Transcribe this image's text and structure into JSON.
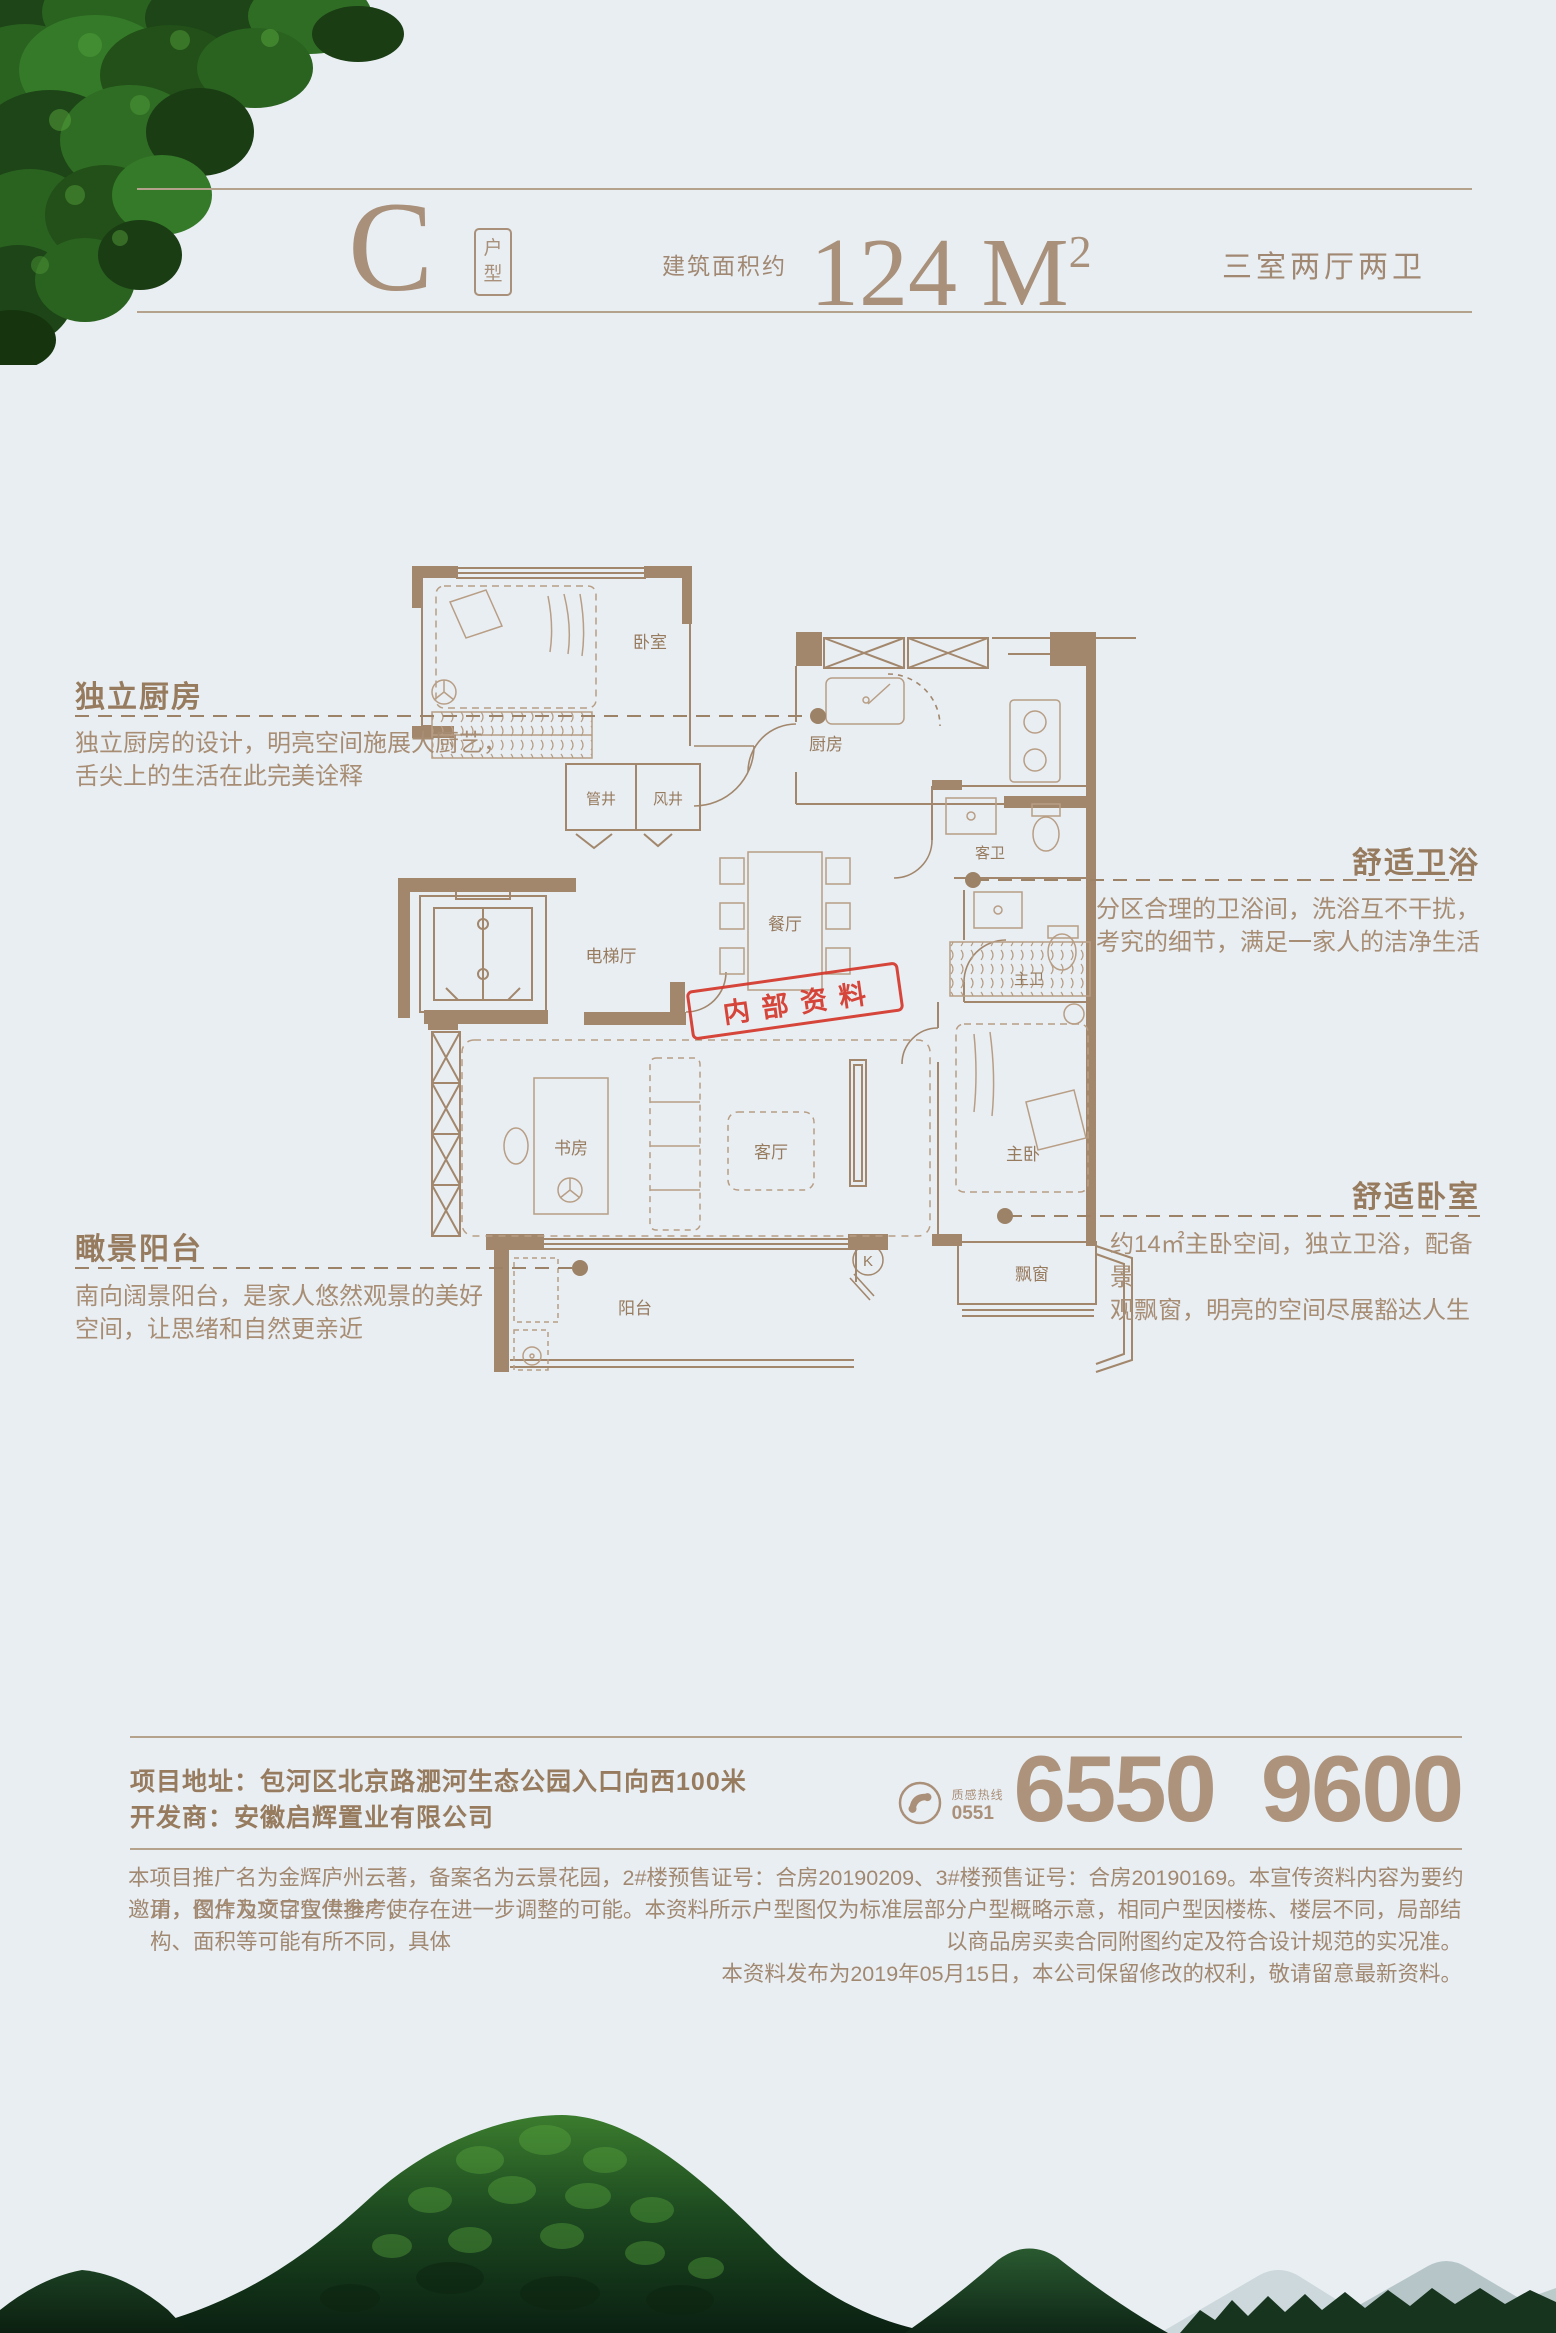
{
  "page": {
    "bg": "#e9eef3",
    "accent_brown": "#9a7e61",
    "rule_color": "#b5a28c",
    "stamp_red": "#d5372b"
  },
  "header": {
    "unit_letter": "C",
    "unit_label_top": "户",
    "unit_label_bottom": "型",
    "area_prefix": "建筑面积约",
    "area_number": "124 M",
    "area_superscript": "2",
    "layout_summary": "三室两厅两卫"
  },
  "floor_plan": {
    "rooms": [
      {
        "id": "bedroom2",
        "label": "卧室"
      },
      {
        "id": "kitchen",
        "label": "厨房"
      },
      {
        "id": "pipe-shaft",
        "label": "管井"
      },
      {
        "id": "air-shaft",
        "label": "风井"
      },
      {
        "id": "elevator-hall",
        "label": "电梯厅"
      },
      {
        "id": "dining-room",
        "label": "餐厅"
      },
      {
        "id": "guest-bath",
        "label": "客卫"
      },
      {
        "id": "master-bath",
        "label": "主卫"
      },
      {
        "id": "study",
        "label": "书房"
      },
      {
        "id": "living-room",
        "label": "客厅"
      },
      {
        "id": "master-bedroom",
        "label": "主卧"
      },
      {
        "id": "balcony",
        "label": "阳台"
      },
      {
        "id": "bay-window",
        "label": "飘窗"
      }
    ],
    "marker_k": "K",
    "stamp_text": "内部资料"
  },
  "annotations": [
    {
      "id": "kitchen",
      "side": "left",
      "title": "独立厨房",
      "lines": [
        "独立厨房的设计，明亮空间施展大厨艺，",
        "舌尖上的生活在此完美诠释"
      ]
    },
    {
      "id": "bath",
      "side": "right",
      "title": "舒适卫浴",
      "lines": [
        "分区合理的卫浴间，洗浴互不干扰，",
        "考究的细节，满足一家人的洁净生活"
      ]
    },
    {
      "id": "balcony",
      "side": "left",
      "title": "瞰景阳台",
      "lines": [
        "南向阔景阳台，是家人悠然观景的美好",
        "空间，让思绪和自然更亲近"
      ]
    },
    {
      "id": "bedroom",
      "side": "right",
      "title": "舒适卧室",
      "lines": [
        "约14㎡主卧空间，独立卫浴，配备景",
        "观飘窗，明亮的空间尽展豁达人生"
      ]
    }
  ],
  "footer": {
    "address_label": "项目地址：",
    "address_value": "包河区北京路淝河生态公园入口向西100米",
    "developer_label": "开发商：",
    "developer_value": "安徽启辉置业有限公司",
    "hotline_icon": "phone-icon",
    "hotline_label": "质感热线",
    "hotline_code": "0551",
    "phone_number": "6550 9600",
    "disclaimer": [
      "本项目推广名为金辉庐州云著，备案名为云景花园，2#楼预售证号：合房20190209、3#楼预售证号：合房20190169。本宣传资料内容为要约邀请，仅作为项目宣传推广使",
      "用，图片及文字仅供参考，存在进一步调整的可能。本资料所示户型图仅为标准层部分户型概略示意，相同户型因楼栋、楼层不同，局部结构、面积等可能有所不同，具体",
      "以商品房买卖合同附图约定及符合设计规范的实况准。",
      "本资料发布为2019年05月15日，本公司保留修改的权利，敬请留意最新资料。"
    ]
  }
}
